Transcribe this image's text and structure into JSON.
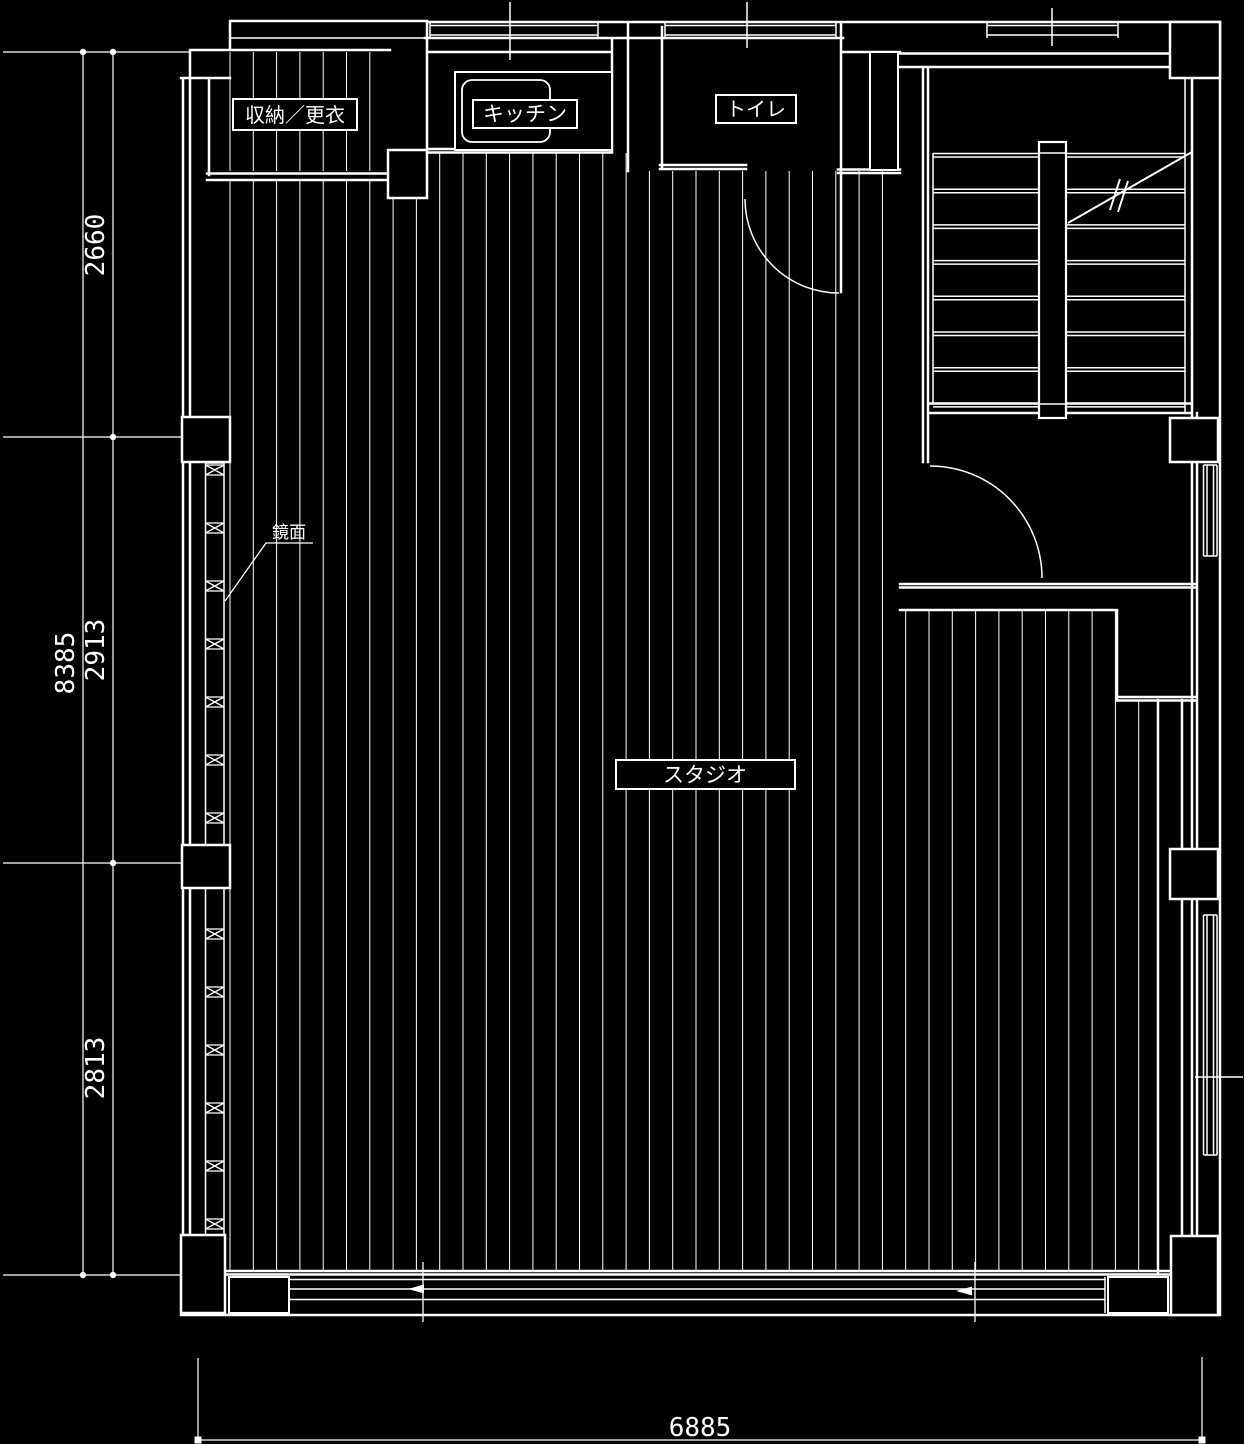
{
  "drawing": {
    "type": "architectural-floor-plan",
    "colors": {
      "background": "#000000",
      "line": "#ffffff"
    },
    "rooms": {
      "storage": {
        "label": "収納／更衣"
      },
      "kitchen": {
        "label": "キッチン"
      },
      "toilet": {
        "label": "トイレ"
      },
      "studio": {
        "label": "スタジオ"
      }
    },
    "annotations": {
      "mirror": {
        "label": "鏡面"
      }
    },
    "dimensions": {
      "left_outer_total": "8385",
      "left_top": "2660",
      "left_middle": "2913",
      "left_bottom": "2813",
      "bottom_width": "6885"
    }
  }
}
